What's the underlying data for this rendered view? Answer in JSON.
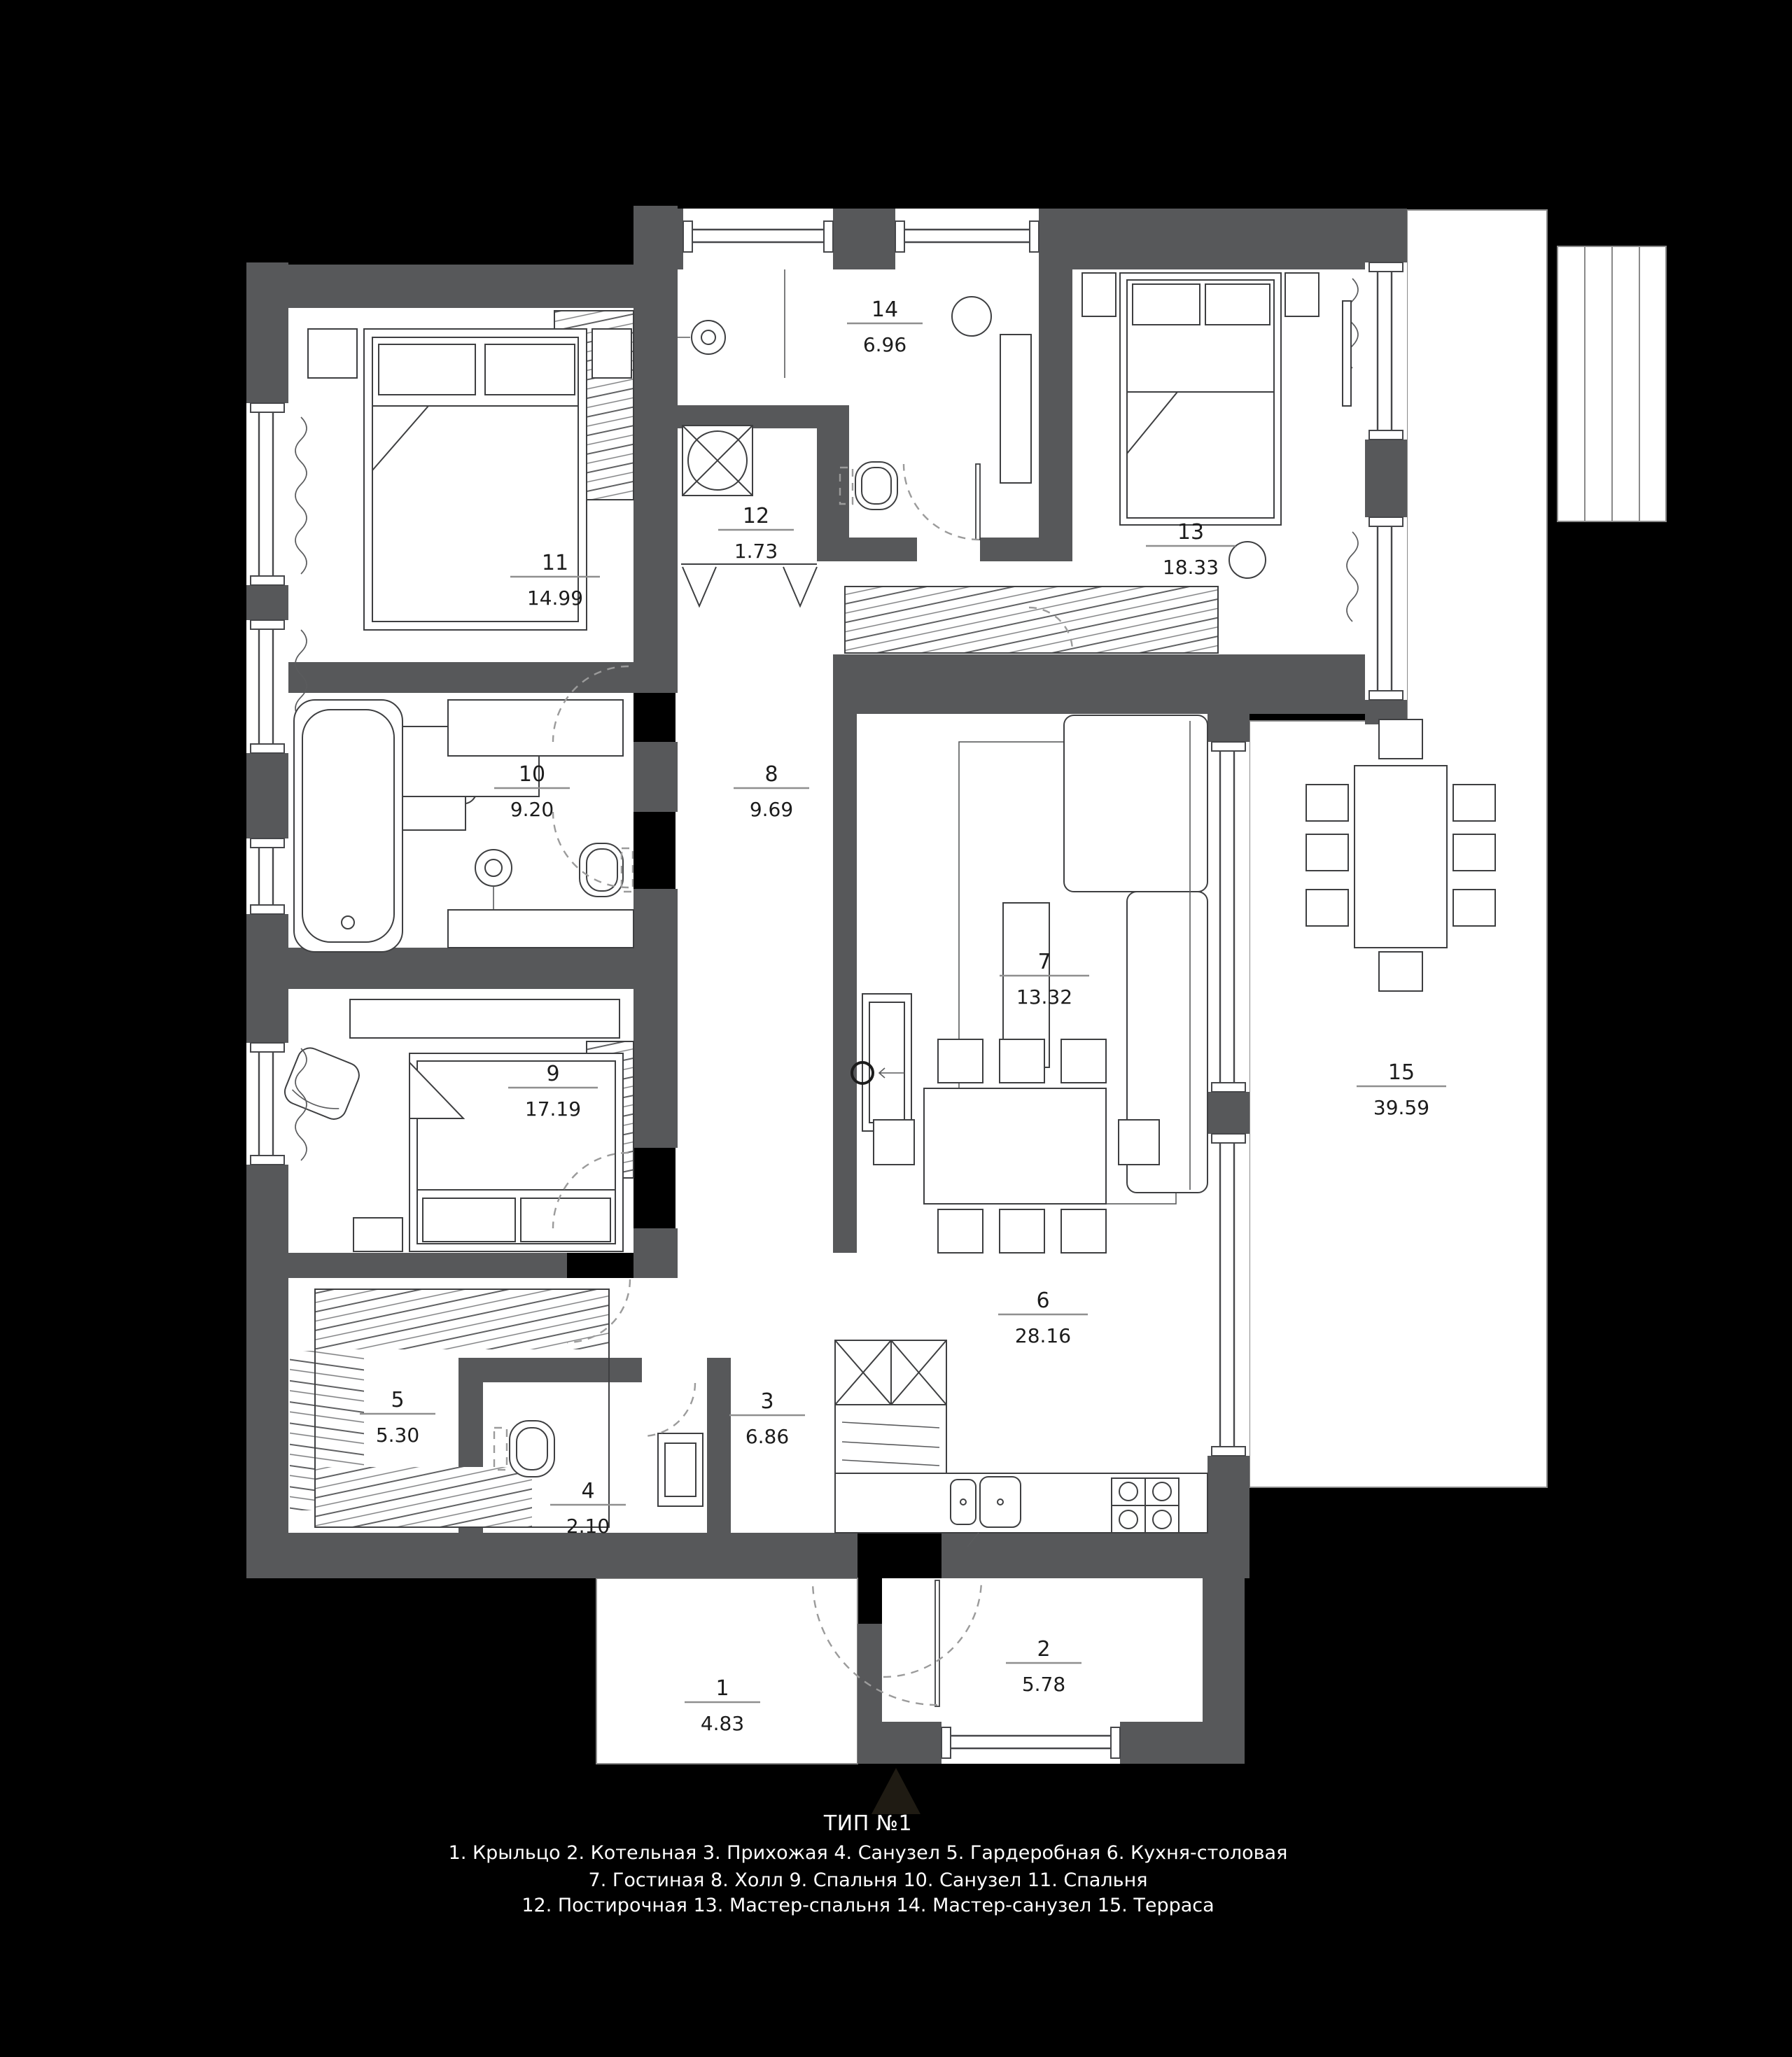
{
  "legend": {
    "title": "ТИП №1",
    "line1": "1. Крыльцо 2. Котельная 3. Прихожая 4. Санузел 5. Гардеробная 6. Кухня-столовая",
    "line2": "7. Гостиная 8. Холл  9. Спальня  10. Санузел  11. Спальня",
    "line3": "12. Постирочная  13. Мастер-спальня  14. Мастер-санузел  15. Терраса"
  },
  "rooms": [
    {
      "number": "1",
      "area": "4.83",
      "name": "Крыльцо"
    },
    {
      "number": "2",
      "area": "5.78",
      "name": "Котельная"
    },
    {
      "number": "3",
      "area": "6.86",
      "name": "Прихожая"
    },
    {
      "number": "4",
      "area": "2.10",
      "name": "Санузел"
    },
    {
      "number": "5",
      "area": "5.30",
      "name": "Гардеробная"
    },
    {
      "number": "6",
      "area": "28.16",
      "name": "Кухня-столовая"
    },
    {
      "number": "7",
      "area": "13.32",
      "name": "Гостиная"
    },
    {
      "number": "8",
      "area": "9.69",
      "name": "Холл"
    },
    {
      "number": "9",
      "area": "17.19",
      "name": "Спальня"
    },
    {
      "number": "10",
      "area": "9.20",
      "name": "Санузел"
    },
    {
      "number": "11",
      "area": "14.99",
      "name": "Спальня"
    },
    {
      "number": "12",
      "area": "1.73",
      "name": "Постирочная"
    },
    {
      "number": "13",
      "area": "18.33",
      "name": "Мастер-спальня"
    },
    {
      "number": "14",
      "area": "6.96",
      "name": "Мастер-санузел"
    },
    {
      "number": "15",
      "area": "39.59",
      "name": "Терраса"
    }
  ],
  "colors": {
    "background": "#000000",
    "wall": "#57585a",
    "floor": "#ffffff",
    "line": "#3e3f41",
    "label_text": "#1c1c1c",
    "legend_text": "#ffffff"
  }
}
